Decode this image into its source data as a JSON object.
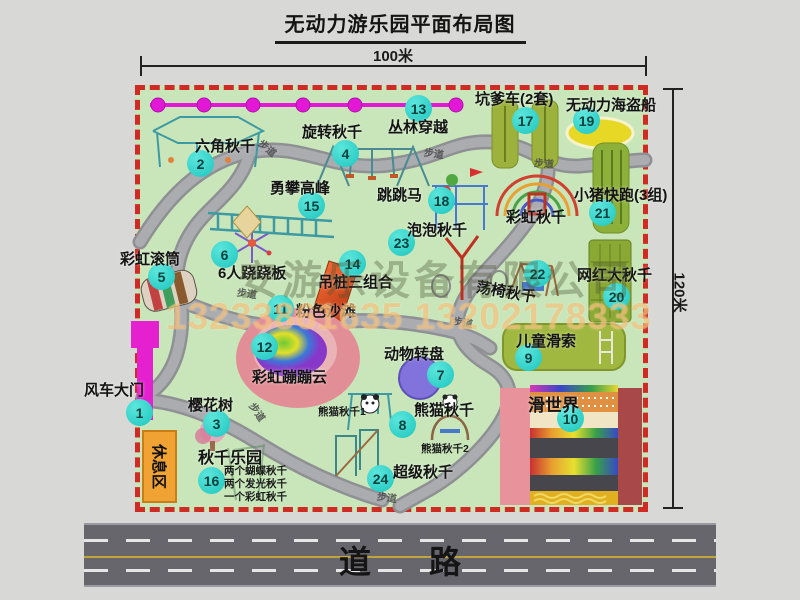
{
  "title": "无动力游乐园平面布局图",
  "dimensions": {
    "width": "100米",
    "height": "120米"
  },
  "road_label": "道路",
  "watermark": {
    "company": "安游乐设备有限公司",
    "phone": "13233861635 13202178333"
  },
  "map": {
    "rest_area": "休息区",
    "walkway": "步道",
    "rainbow_swing": "彩虹秋千",
    "panda_swing_1": "熊猫秋千1",
    "panda_swing_2": "熊猫秋千2",
    "swing_park_notes": [
      "两个蝴蝶秋千",
      "两个发光秋千",
      "一个彩虹秋千"
    ]
  },
  "items": [
    {
      "num": "1",
      "label": "风车大门"
    },
    {
      "num": "2",
      "label": "六角秋千"
    },
    {
      "num": "3",
      "label": "樱花树"
    },
    {
      "num": "4",
      "label": "旋转秋千"
    },
    {
      "num": "5",
      "label": "彩虹滚筒"
    },
    {
      "num": "6",
      "label": "6人跷跷板"
    },
    {
      "num": "7",
      "label": "动物转盘"
    },
    {
      "num": "8",
      "label": "熊猫秋千"
    },
    {
      "num": "9",
      "label": "儿童滑索"
    },
    {
      "num": "10",
      "label": "滑世界"
    },
    {
      "num": "11",
      "label": "粉色沙滩"
    },
    {
      "num": "12",
      "label": "彩虹蹦蹦云"
    },
    {
      "num": "13",
      "label": "丛林穿越"
    },
    {
      "num": "14",
      "label": "吊桩三组合"
    },
    {
      "num": "15",
      "label": "勇攀高峰"
    },
    {
      "num": "16",
      "label": "秋千乐园"
    },
    {
      "num": "17",
      "label": "坑爹车(2套)"
    },
    {
      "num": "18",
      "label": "跳跳马"
    },
    {
      "num": "19",
      "label": "无动力海盗船"
    },
    {
      "num": "20",
      "label": "网红大秋千"
    },
    {
      "num": "21",
      "label": "小猪快跑(3组)"
    },
    {
      "num": "22",
      "label": "荡椅秋千"
    },
    {
      "num": "23",
      "label": "泡泡秋千"
    },
    {
      "num": "24",
      "label": "超级秋千"
    }
  ]
}
